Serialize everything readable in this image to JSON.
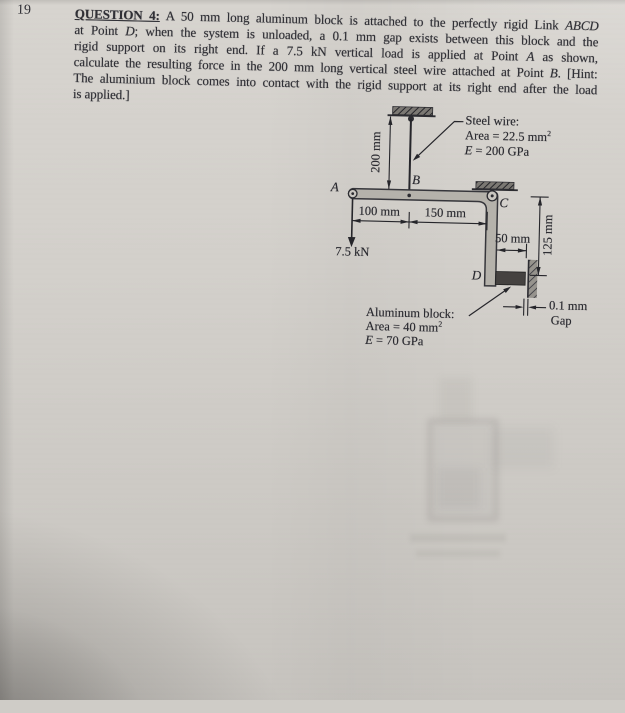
{
  "page_number": "19",
  "question": {
    "lines": [
      [
        {
          "t": "QUESTION 4:",
          "b": true,
          "u": true
        },
        {
          "t": " A 50 mm long aluminum block is attached to the perfectly rigid Link "
        },
        {
          "t": "ABCD",
          "i": true
        }
      ],
      [
        {
          "t": "at Point "
        },
        {
          "t": "D",
          "i": true
        },
        {
          "t": "; when the system is unloaded, a 0.1 mm gap exists between this block and the"
        }
      ],
      [
        {
          "t": "rigid support on its right end. If a 7.5 kN vertical load is applied at Point "
        },
        {
          "t": "A",
          "i": true
        },
        {
          "t": " as shown,"
        }
      ],
      [
        {
          "t": "calculate the resulting force in the 200 mm long vertical steel wire attached at Point "
        },
        {
          "t": "B",
          "i": true
        },
        {
          "t": ". [Hint:"
        }
      ],
      [
        {
          "t": "The aluminium block comes into contact with the rigid support at its right end after the load"
        }
      ],
      [
        {
          "t": "is applied.]"
        }
      ]
    ]
  },
  "diagram": {
    "points": {
      "a": "A",
      "b": "B",
      "c": "C",
      "d": "D"
    },
    "dimensions": {
      "wire_length": "200 mm",
      "a_to_b": "100 mm",
      "b_to_c": "150 mm",
      "block_length": "50 mm",
      "c_to_d": "125 mm",
      "gap_value": "0.1 mm",
      "gap_word": "Gap"
    },
    "load": "7.5 kN",
    "steel_wire_note": {
      "title": [
        {
          "t": "Steel wire:"
        }
      ],
      "area": [
        {
          "t": "Area = 22.5 mm"
        },
        {
          "t": "2",
          "sup": true
        }
      ],
      "modulus": [
        {
          "t": "E",
          "i": true
        },
        {
          "t": " = 200 GPa"
        }
      ]
    },
    "aluminum_note": {
      "title": [
        {
          "t": "Aluminum block:"
        }
      ],
      "area": [
        {
          "t": "Area = 40 mm"
        },
        {
          "t": "2",
          "sup": true
        }
      ],
      "modulus": [
        {
          "t": "E",
          "i": true
        },
        {
          "t": " = 70 GPa"
        }
      ]
    },
    "colors": {
      "ink": "#26262b",
      "link_fill": "#b5b2ab",
      "block_fill": "#454240"
    }
  }
}
